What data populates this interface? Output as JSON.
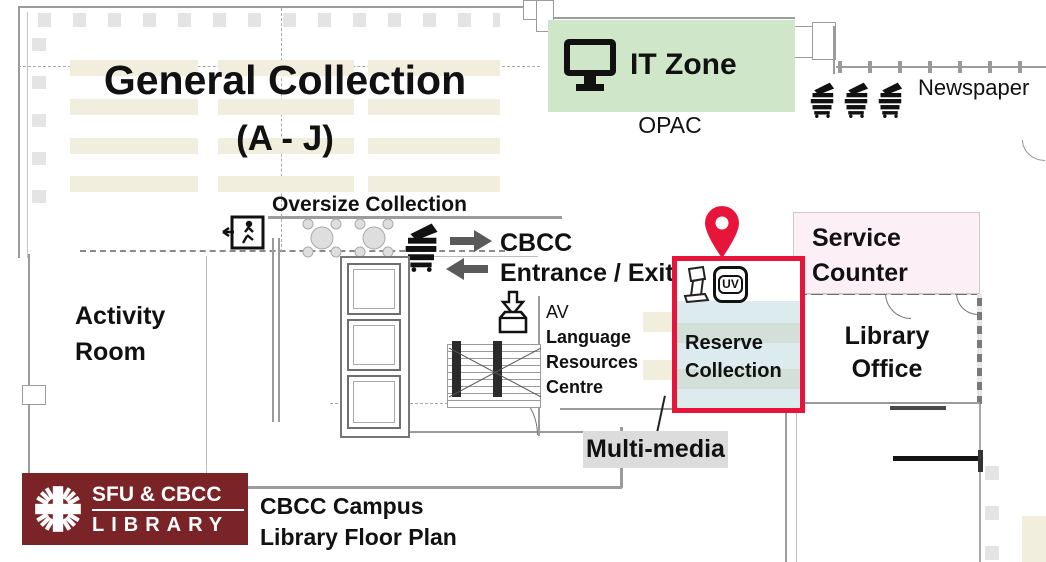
{
  "theme": {
    "green": "#cfe7c8",
    "pink": "#fcf0f6",
    "blue": "#dcebee",
    "blue_band": "#d3dfd9",
    "beige": "#f2eedd",
    "red": "#e8153a",
    "maroon": "#7b2428",
    "gray_label": "#dcdcdc",
    "arrow": "#5a5a5a",
    "wall": "#9b9b9b",
    "ink": "#111111"
  },
  "zones": {
    "general_collection": {
      "title": "General Collection",
      "range": "(A - J)"
    },
    "oversize": {
      "label": "Oversize Collection"
    },
    "it_zone": {
      "label": "IT Zone"
    },
    "opac": {
      "label": "OPAC"
    },
    "newspaper": {
      "label": "Newspaper"
    },
    "entrance": {
      "line1": "CBCC",
      "line2": "Entrance / Exit"
    },
    "activity_room": {
      "line1": "Activity",
      "line2": "Room"
    },
    "av_centre": {
      "line1": "AV",
      "line2": "Language",
      "line3": "Resources",
      "line4": "Centre"
    },
    "reserve": {
      "line1": "Reserve",
      "line2": "Collection",
      "uv_badge": "UV"
    },
    "service_counter": {
      "line1": "Service",
      "line2": "Counter"
    },
    "library_office": {
      "line1": "Library",
      "line2": "Office"
    },
    "multimedia": {
      "label": "Multi-media"
    }
  },
  "legend": {
    "logo_line1": "SFU & CBCC",
    "logo_line2": "LIBRARY",
    "caption_line1": "CBCC Campus",
    "caption_line2": "Library Floor Plan"
  },
  "icons": {
    "it_zone": "computer-monitor",
    "opac_area": "opac-terminal",
    "newspaper": "newspaper-rack",
    "copier": "copier-printer",
    "exit": "emergency-exit",
    "entrance_arrows": "direction-arrows",
    "book_drop": "book-return-box",
    "reserve_marker": "location-pin",
    "reserve_kiosk": "self-checkout-kiosk",
    "reserve_uv": "uv-sterilizer",
    "tables": "reading-table",
    "logo": "caritas-cross"
  }
}
